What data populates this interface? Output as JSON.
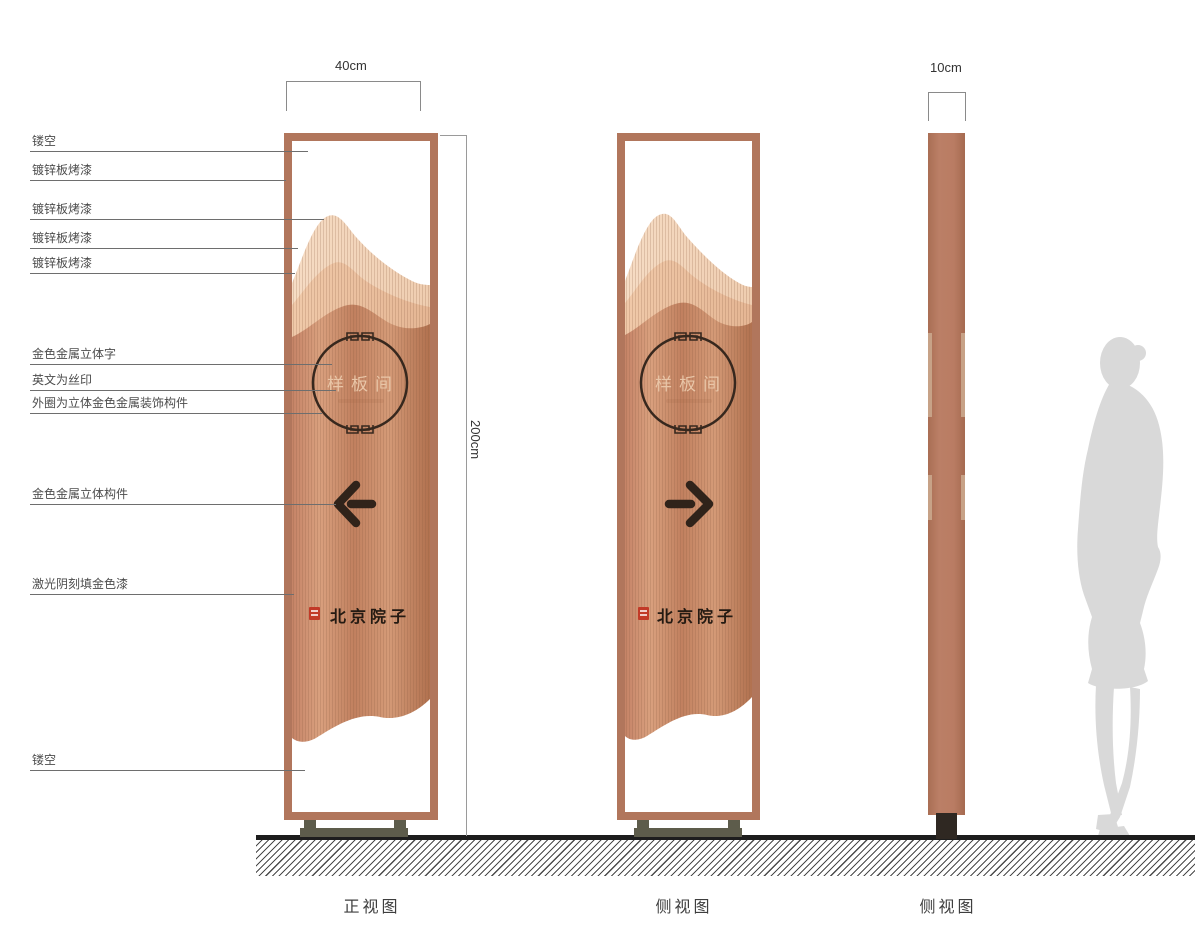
{
  "callouts": [
    {
      "label": "镂空"
    },
    {
      "label": "镀锌板烤漆"
    },
    {
      "label": "镀锌板烤漆"
    },
    {
      "label": "镀锌板烤漆"
    },
    {
      "label": "镀锌板烤漆"
    },
    {
      "label": "金色金属立体字"
    },
    {
      "label": "英文为丝印"
    },
    {
      "label": "外圈为立体金色金属装饰构件"
    },
    {
      "label": "金色金属立体构件"
    },
    {
      "label": "激光阴刻填金色漆"
    },
    {
      "label": "镂空"
    }
  ],
  "dimensions": {
    "front_width": "40cm",
    "total_height": "200cm",
    "side_width": "10cm"
  },
  "panel": {
    "circle_label": "样板间",
    "brand_label": "北京院子"
  },
  "views": [
    {
      "label": "正视图"
    },
    {
      "label": "侧视图"
    },
    {
      "label": "侧视图"
    }
  ],
  "colors": {
    "frame_copper": "#b1765c",
    "panel_copper": "#cd9274",
    "mountain_light": "#f4d8bf",
    "mountain_mid": "#eec4a4",
    "dark_metal": "#33251c",
    "circle_text": "#e9c6a8",
    "seal_red": "#c23a28",
    "base_metal": "#5d5c4b",
    "silhouette_gray": "#d9d9d9",
    "ground_black": "#1d1d1d"
  }
}
